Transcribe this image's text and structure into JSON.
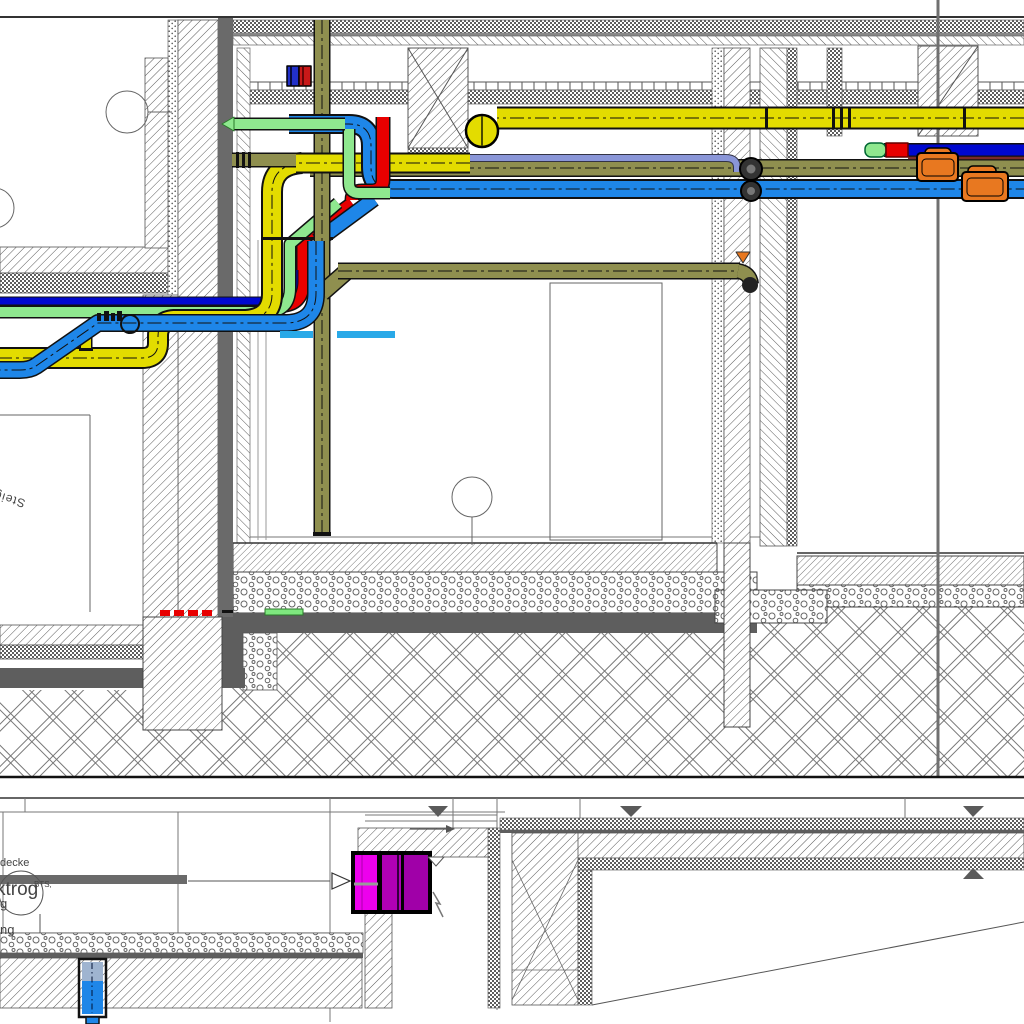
{
  "drawing": {
    "title": "MEP building section detail",
    "labels": {
      "riser": "Steig",
      "ceiling_partial": "decke",
      "trough_partial": "ktrog",
      "trough_sub": "BTS,",
      "partial_g": "g",
      "partial_ng": "ng"
    },
    "colors": {
      "yellow": "#E3DC00",
      "olive": "#8F8F4F",
      "blue": "#1E86E8",
      "navy": "#0008D0",
      "red": "#E80000",
      "green": "#8FE88F",
      "cyan_dash": "#29A9E8",
      "magenta_bright": "#ED00ED",
      "magenta_mid": "#B000B5",
      "magenta_dark": "#A000A8",
      "orange": "#E87820",
      "periwinkle": "#8A96D8",
      "solid_gray": "#6A6A6A",
      "slab_gray": "#5E5E5E",
      "steel_blue": "#9FB4D0",
      "maroon": "#7A2A2A"
    }
  }
}
